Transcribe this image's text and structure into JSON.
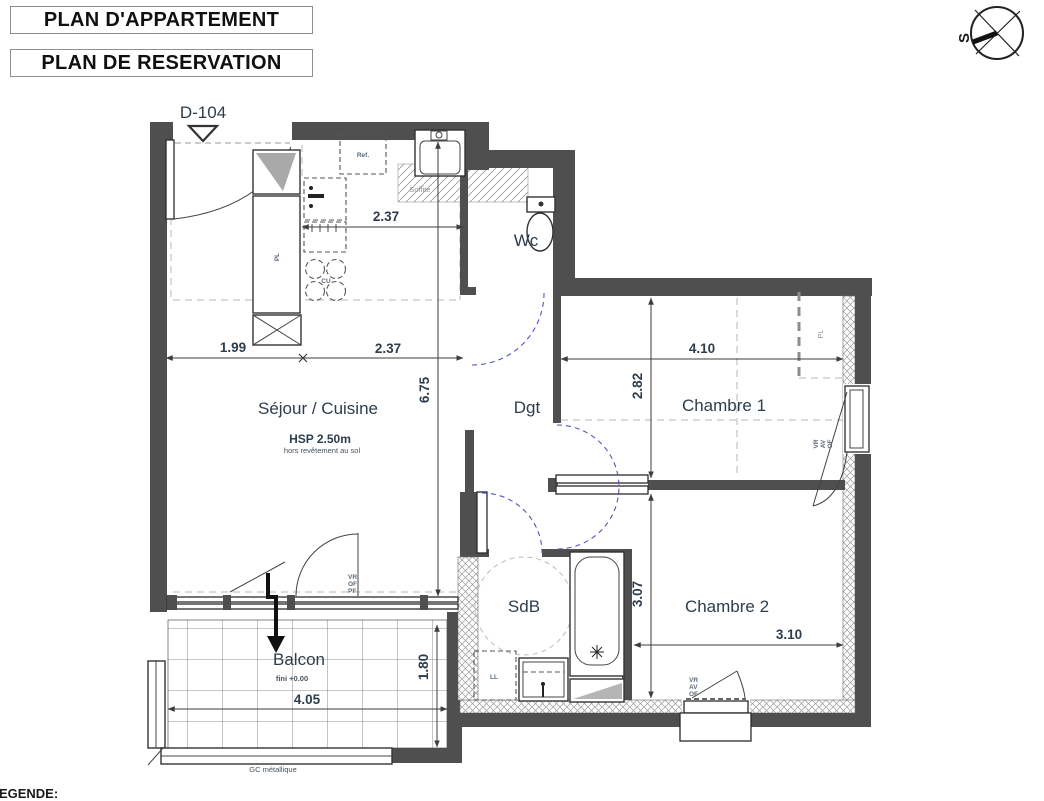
{
  "titles": {
    "plan_appartement": "PLAN D'APPARTEMENT",
    "plan_reservation": "PLAN DE RESERVATION"
  },
  "compass": {
    "south": "S"
  },
  "unit": {
    "id": "D-104"
  },
  "rooms": {
    "sejour": {
      "name": "Séjour / Cuisine",
      "height": "HSP 2.50m",
      "height_note": "hors revêtement au sol"
    },
    "wc": {
      "name": "Wc"
    },
    "dgt": {
      "name": "Dgt"
    },
    "chambre1": {
      "name": "Chambre 1"
    },
    "sdb": {
      "name": "SdB"
    },
    "chambre2": {
      "name": "Chambre 2"
    },
    "balcon": {
      "name": "Balcon",
      "level": "fini +0.00",
      "railing": "GC métallique"
    }
  },
  "dims": {
    "entry_width": "1.99",
    "kitchen_width": "2.37",
    "kitchen_counter": "2.37",
    "sejour_depth": "6.75",
    "ch1_width": "4.10",
    "ch1_depth": "2.82",
    "ch2_depth": "3.07",
    "ch2_width": "3.10",
    "balcon_width": "4.05",
    "balcon_depth": "1.80"
  },
  "tags": {
    "pl": "PL",
    "ref": "Ref.",
    "cu": "CU",
    "ll": "LL",
    "soffite": "Soffite",
    "gc": "GC métallique",
    "vr": "VR",
    "av": "AV",
    "of": "OF",
    "pf": "PF"
  },
  "legend": {
    "title": "LEGENDE:"
  }
}
